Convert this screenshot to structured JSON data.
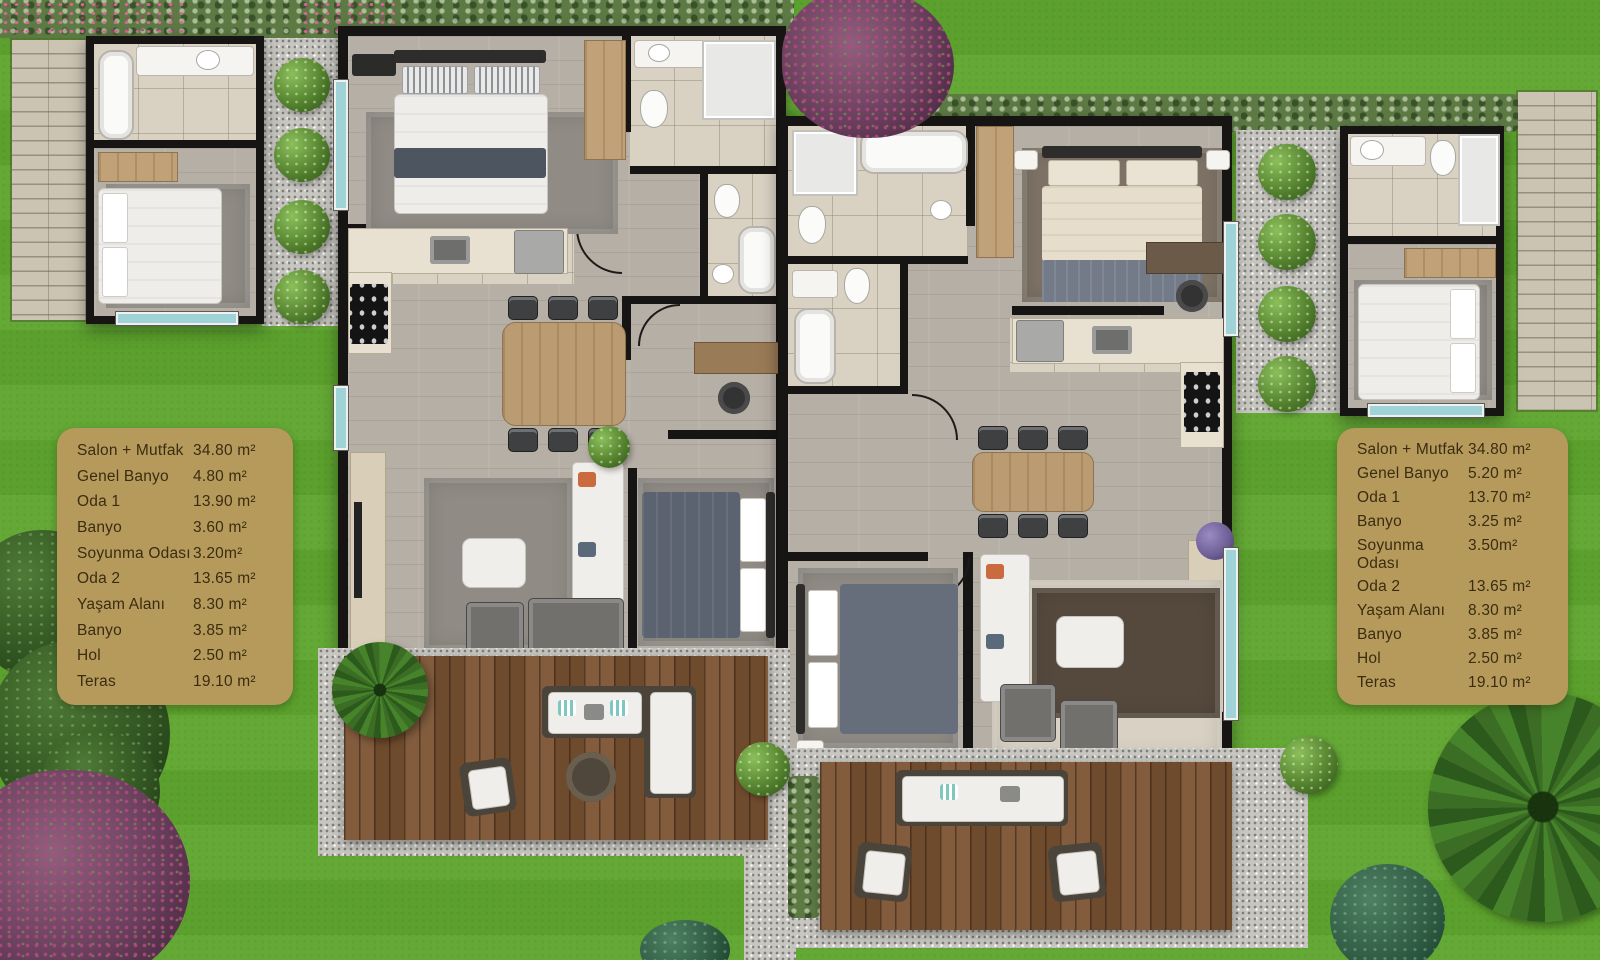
{
  "legend_left": {
    "rows": [
      {
        "label": "Salon + Mutfak",
        "value": "34.80 m²"
      },
      {
        "label": "Genel Banyo",
        "value": "4.80 m²"
      },
      {
        "label": "Oda 1",
        "value": "13.90 m²"
      },
      {
        "label": "Banyo",
        "value": "3.60 m²"
      },
      {
        "label": "Soyunma Odası",
        "value": "3.20m²"
      },
      {
        "label": "Oda 2",
        "value": "13.65 m²"
      },
      {
        "label": "Yaşam Alanı",
        "value": "8.30 m²"
      },
      {
        "label": "Banyo",
        "value": "3.85 m²"
      },
      {
        "label": "Hol",
        "value": "2.50 m²"
      },
      {
        "label": "Teras",
        "value": "19.10 m²"
      }
    ]
  },
  "legend_right": {
    "rows": [
      {
        "label": "Salon + Mutfak",
        "value": "34.80 m²"
      },
      {
        "label": "Genel Banyo",
        "value": "5.20 m²"
      },
      {
        "label": "Oda 1",
        "value": "13.70 m²"
      },
      {
        "label": "Banyo",
        "value": "3.25 m²"
      },
      {
        "label": "Soyunma Odası",
        "value": "3.50m²"
      },
      {
        "label": "Oda 2",
        "value": "13.65 m²"
      },
      {
        "label": "Yaşam Alanı",
        "value": "8.30 m²"
      },
      {
        "label": "Banyo",
        "value": "3.85 m²"
      },
      {
        "label": "Hol",
        "value": "2.50 m²"
      },
      {
        "label": "Teras",
        "value": "19.10 m²"
      }
    ]
  },
  "palette": {
    "grass": "#5fa52f",
    "hedge": "#5d7a45",
    "gravel": "#c7c6c0",
    "paver": "#ccc4b3",
    "deck_wood": "#7a5231",
    "wall": "#171513",
    "interior_wood": "#b6afa5",
    "bathroom_tile": "#d9d2c3",
    "window_glass": "#9fd3d8",
    "legend_background": "#b59a5c",
    "legend_text": "#3b2c10",
    "accent_flowers": "#b14a7f"
  }
}
